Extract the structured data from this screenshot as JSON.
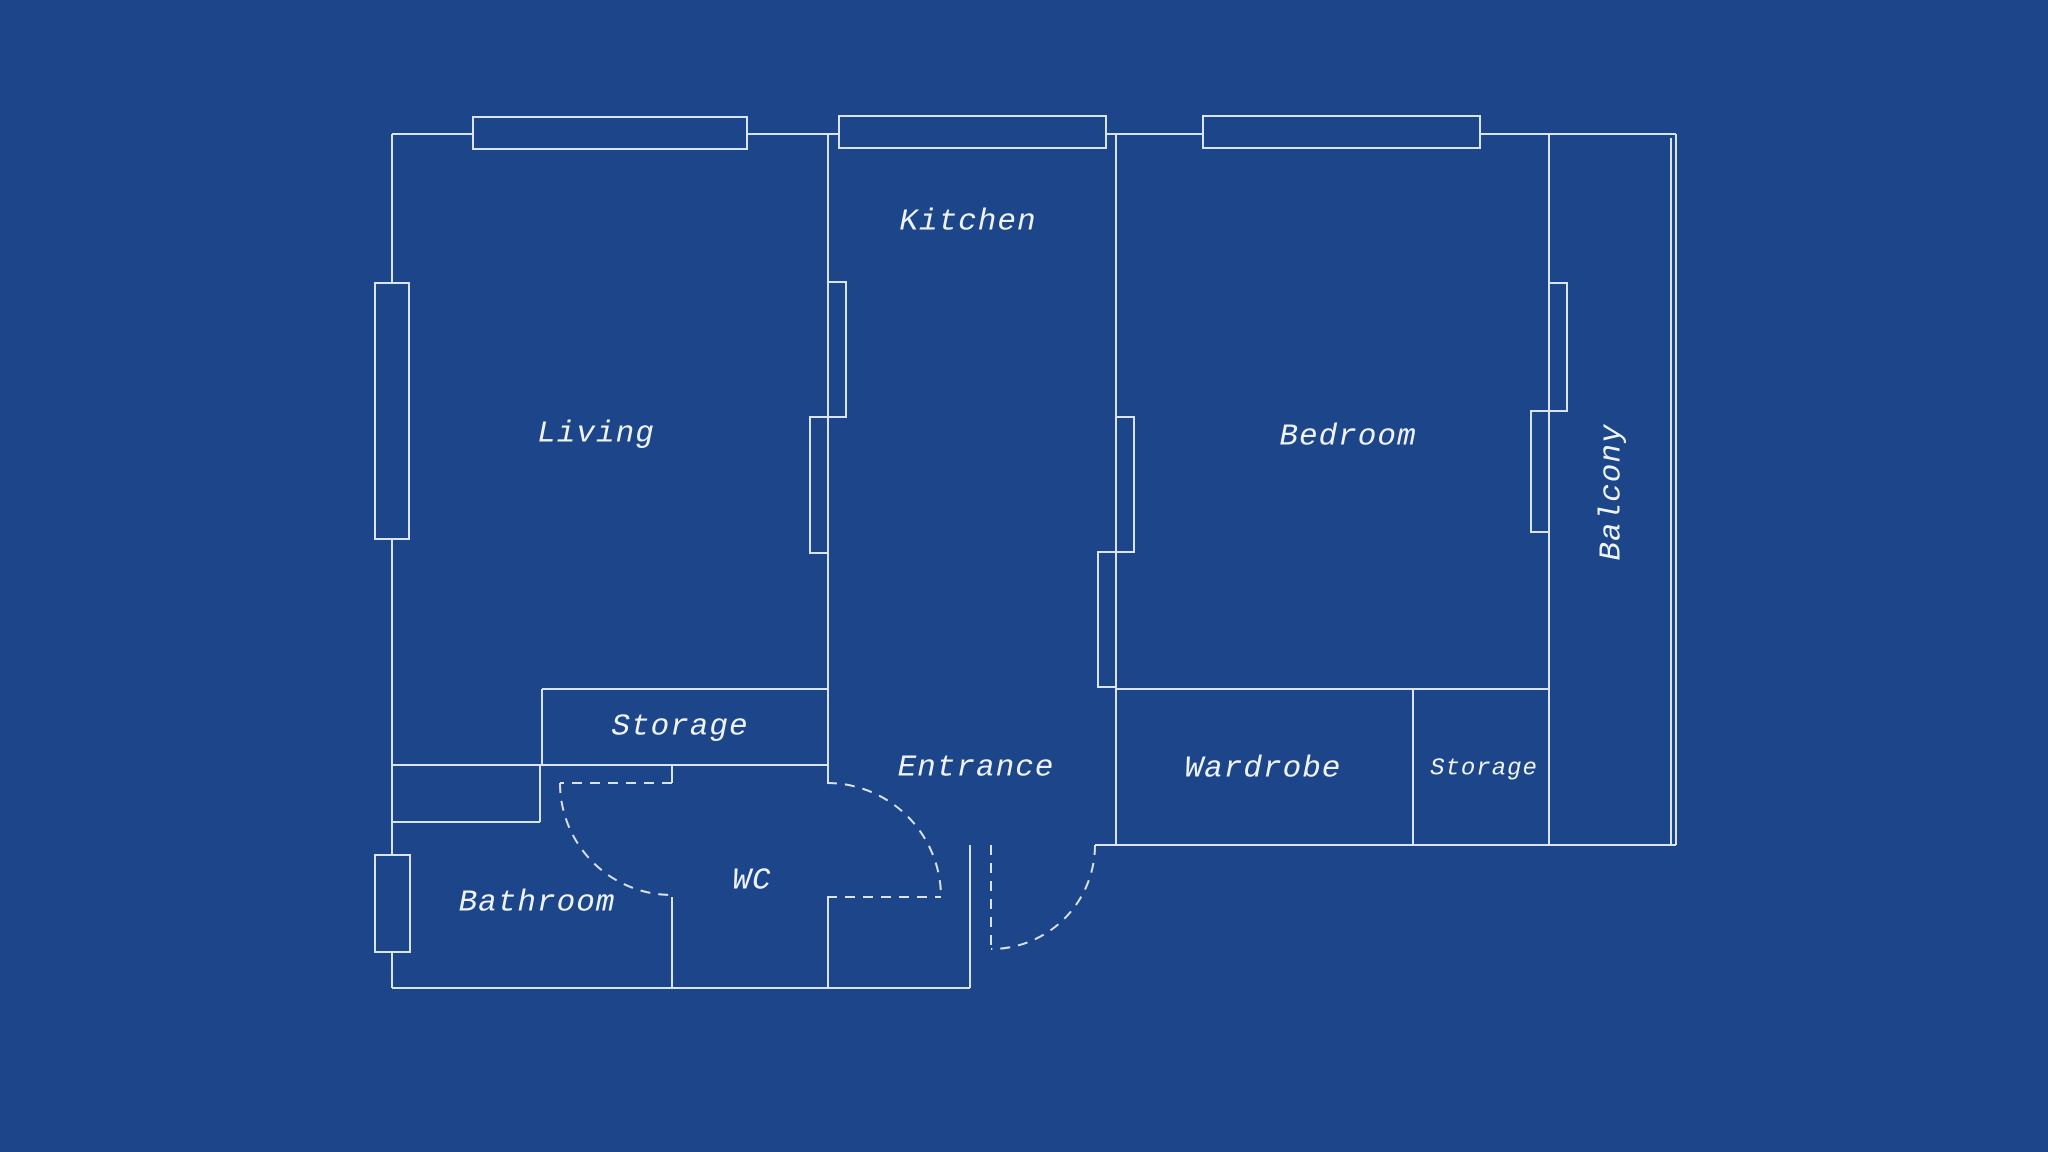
{
  "title": "Apartment floor plan blueprint",
  "colors": {
    "background": "#1d4589",
    "line": "#d9e3f2",
    "text": "#eef3fa"
  },
  "rooms": {
    "living": {
      "label": "Living"
    },
    "kitchen": {
      "label": "Kitchen"
    },
    "bedroom": {
      "label": "Bedroom"
    },
    "balcony": {
      "label": "Balcony"
    },
    "storage_hall": {
      "label": "Storage"
    },
    "entrance": {
      "label": "Entrance"
    },
    "wardrobe": {
      "label": "Wardrobe"
    },
    "storage_bedroom": {
      "label": "Storage"
    },
    "bathroom": {
      "label": "Bathroom"
    },
    "wc": {
      "label": "WC"
    }
  }
}
